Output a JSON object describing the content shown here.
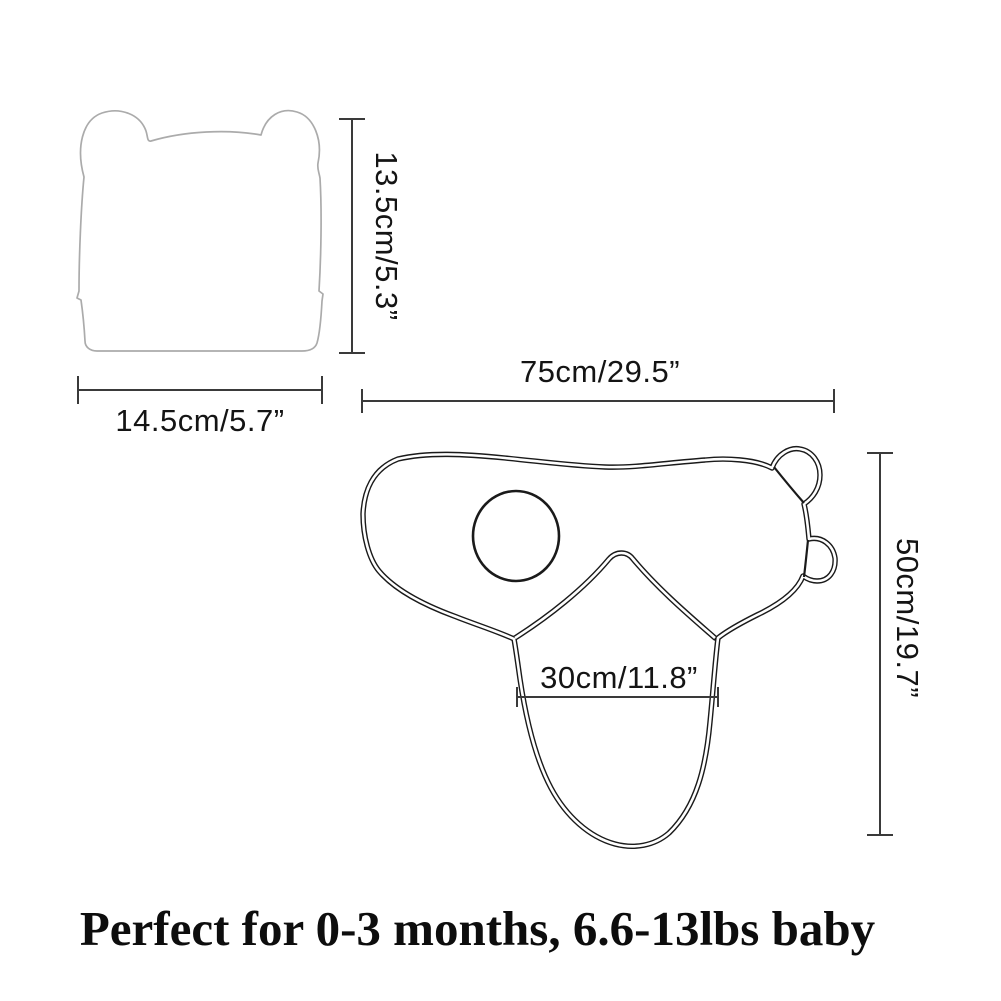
{
  "labels": {
    "hat_height": "13.5cm/5.3”",
    "hat_width": "14.5cm/5.7”",
    "swaddle_width": "75cm/29.5”",
    "swaddle_height": "50cm/19.7”",
    "pouch_width": "30cm/11.8”"
  },
  "caption": "Perfect for 0-3 months, 6.6-13lbs baby",
  "colors": {
    "swaddle_outline": "#1a1a1a",
    "hat_outline": "#ababab",
    "dimension_line": "#3a3a3a",
    "text": "#141414",
    "background": "#ffffff"
  }
}
